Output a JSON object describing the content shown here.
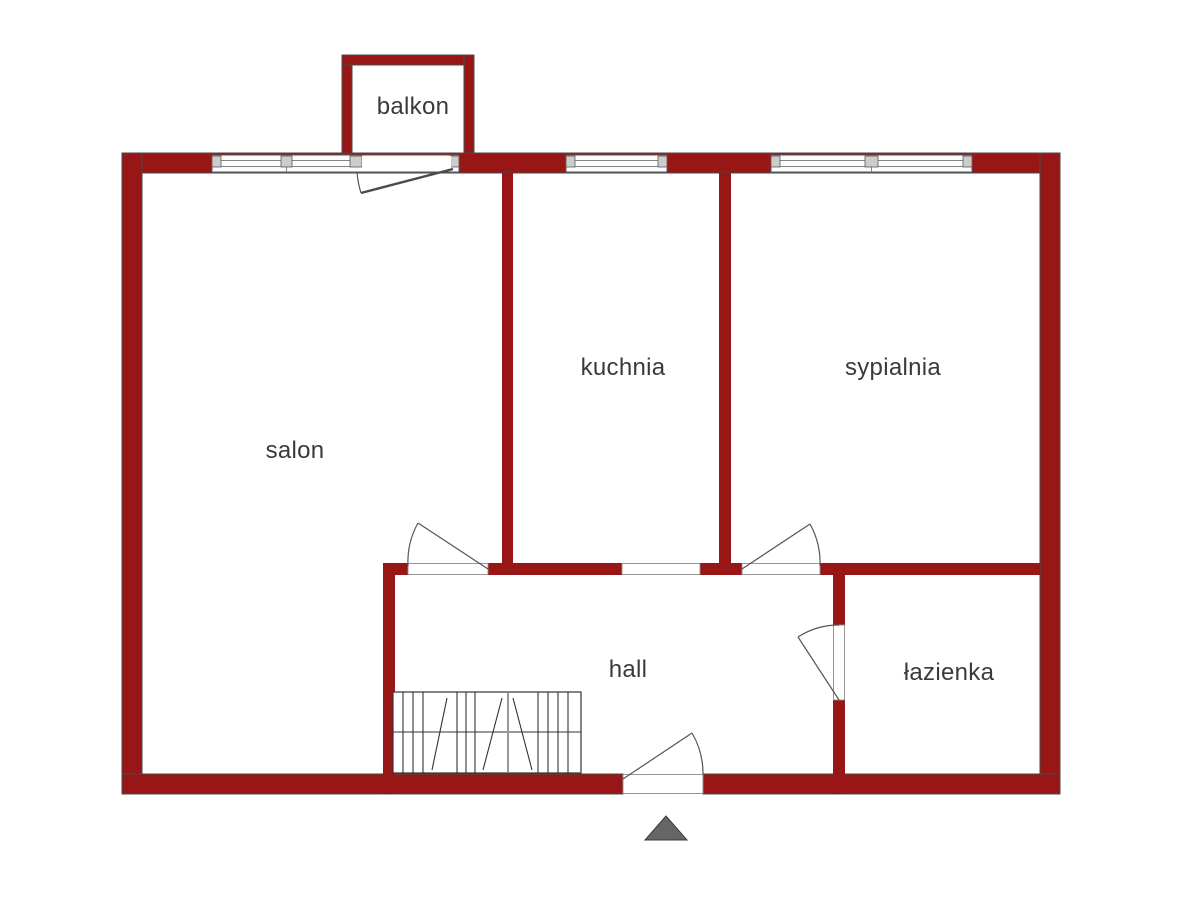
{
  "plan_title": "floor-plan",
  "rooms": [
    {
      "id": "balkon",
      "label": "balkon"
    },
    {
      "id": "salon",
      "label": "salon"
    },
    {
      "id": "kuchnia",
      "label": "kuchnia"
    },
    {
      "id": "sypialnia",
      "label": "sypialnia"
    },
    {
      "id": "hall",
      "label": "hall"
    },
    {
      "id": "lazienka",
      "label": "łazienka"
    }
  ],
  "colors": {
    "wall": "#981616",
    "outline": "#4a4a4a",
    "line": "#555555",
    "opening": "#8a8a8a",
    "frame": "#5a5a5a",
    "mullion": "#cccccc",
    "window_fill": "#fbfdfe",
    "stairs": "#333333",
    "text": "#3a3a3a",
    "marker": "#666666",
    "background": "#ffffff"
  }
}
